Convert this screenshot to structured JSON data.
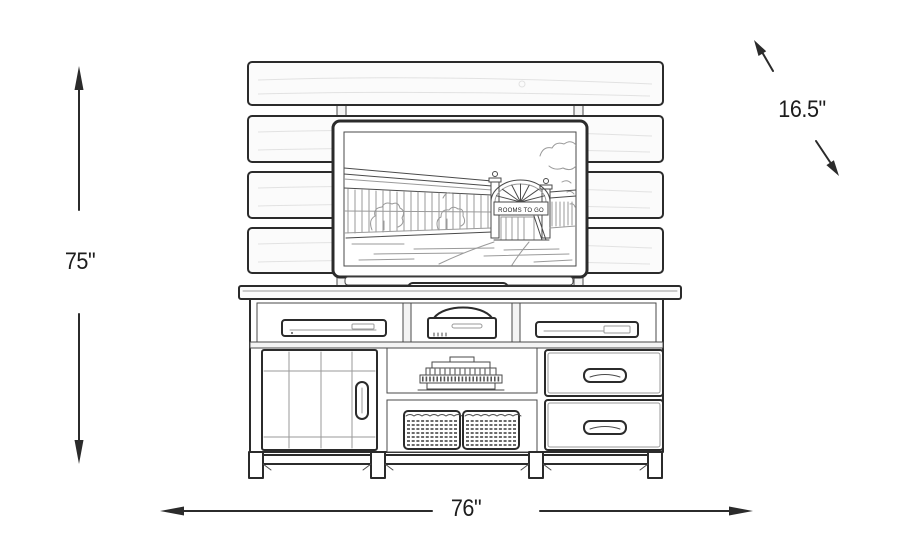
{
  "diagram": {
    "subject": "tv-wall-console-line-drawing",
    "dimensions": {
      "height_label": "75\"",
      "width_label": "76\"",
      "depth_label": "16.5\""
    },
    "tv": {
      "sign_text": "ROOMS TO GO"
    },
    "colors": {
      "ink": "#2b2b2b",
      "background": "#ffffff",
      "label_text": "#1d1d1d"
    }
  }
}
